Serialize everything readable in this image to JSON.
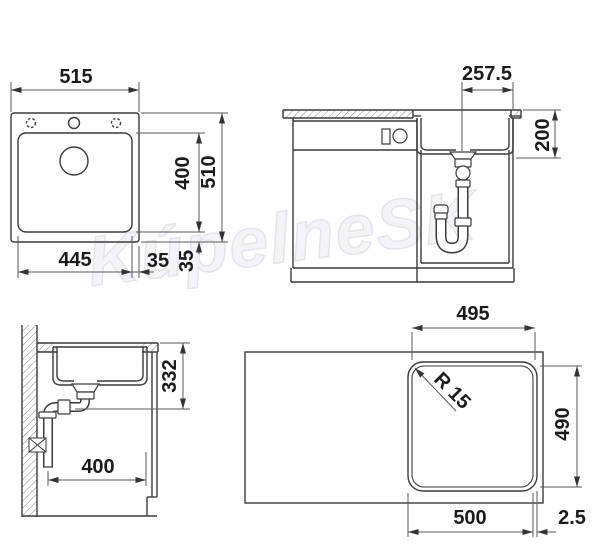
{
  "watermark": {
    "text": "KúpelneSK"
  },
  "drawing_title": "sink-installation-dimension-drawing",
  "colors": {
    "line": "#3a3a3a",
    "dim_line": "#5a5a5a",
    "text": "#1b1b1b",
    "watermark": "#e4e4ec"
  },
  "labels": {
    "top_view": {
      "overall_width": "515",
      "overall_length": "510",
      "bowl_width": "445",
      "bowl_length": "400",
      "edge_offset_h": "35",
      "edge_offset_v": "35"
    },
    "front_view": {
      "drain_offset": "257.5",
      "bowl_depth": "200"
    },
    "side_view": {
      "install_clearance": "332",
      "wall_distance": "400"
    },
    "cutout_view": {
      "cutout_width_top": "495",
      "corner_radius": "R 15",
      "cutout_height": "490",
      "cutout_width_bottom": "500",
      "edge_gap": "2.5"
    }
  }
}
